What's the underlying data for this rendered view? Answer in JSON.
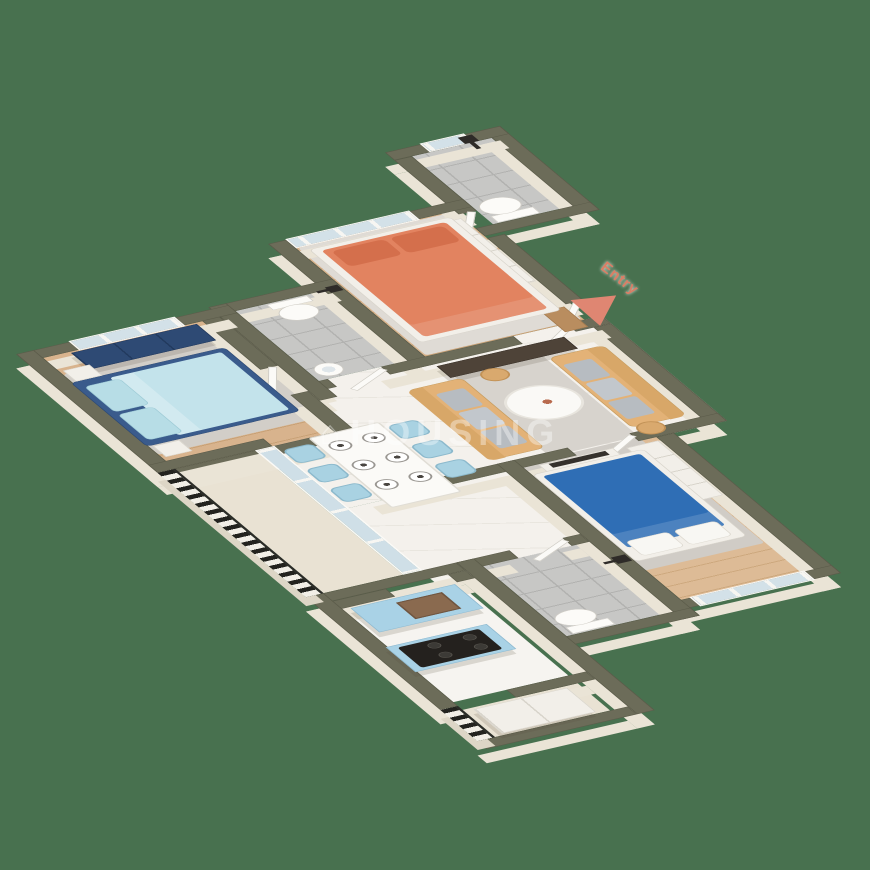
{
  "scene": {
    "background_color": "#48714f",
    "subject": "3D isometric floor plan render of a 3-bedroom apartment"
  },
  "labels": {
    "entry": {
      "text": "Entry",
      "color": "#d97f66",
      "arrow_direction": "lower-left"
    }
  },
  "watermark": {
    "icon_glyph": "⌂",
    "text": "HOUSING",
    "opacity": 0.38
  },
  "palette": {
    "wall_top": "#6c6c59",
    "wall_face": "#eae4d6",
    "wood_floor": "#d8b38d",
    "marble_floor": "#f4f1ec",
    "bath_tile": "#c7c7c5",
    "kitchen_cabinet_blue": "#a9d2e6",
    "sofa_tan": "#e3b277",
    "bed_coral": "#e28360",
    "bed_cyan_duvet": "#c3e3eb",
    "bed_navy_frame": "#3a5b8c",
    "bed_royal_blue": "#2f6eb5",
    "navy_wardrobe": "#2e4a74",
    "dining_chair_blue": "#a9d2e2",
    "rug_gray": "#d2cec8",
    "railing_dark": "#23231f"
  },
  "rooms": [
    {
      "name": "bathroom-top",
      "floor": "gray-tile",
      "features": [
        "shower",
        "toilet",
        "window"
      ]
    },
    {
      "name": "bedroom-coral",
      "floor": "wood",
      "features": [
        "double-bed-coral",
        "built-in-wardrobe",
        "window",
        "rug"
      ]
    },
    {
      "name": "bathroom-common",
      "floor": "gray-tile",
      "features": [
        "toilet",
        "washbasin",
        "shower"
      ]
    },
    {
      "name": "bedroom-navy",
      "floor": "wood",
      "features": [
        "double-bed-cyan-navy-frame",
        "navy-dresser",
        "window",
        "rug",
        "nightstands"
      ]
    },
    {
      "name": "living-room",
      "floor": "marble",
      "features": [
        "sofa-pair-tan",
        "gray-cushions",
        "round-coffee-table",
        "rug",
        "tv-console-brown",
        "side-stools",
        "doormat",
        "entry-door"
      ]
    },
    {
      "name": "dining-area",
      "floor": "marble",
      "features": [
        "dining-table-white",
        "six-blue-chairs",
        "six-place-settings"
      ]
    },
    {
      "name": "bedroom-blue",
      "floor": "wood",
      "features": [
        "double-bed-blue",
        "white-wardrobe",
        "tv-unit",
        "windows",
        "rug"
      ]
    },
    {
      "name": "bathroom-lower",
      "floor": "gray-tile",
      "features": [
        "shower",
        "toilet"
      ]
    },
    {
      "name": "kitchen",
      "floor": "white",
      "features": [
        "sink-counter-blue",
        "hob-counter-blue",
        "gas-stove"
      ]
    },
    {
      "name": "balcony",
      "features": [
        "black-white-railing",
        "sliding-glass-door"
      ]
    },
    {
      "name": "utility-balcony",
      "features": [
        "black-white-railing",
        "tall-white-unit"
      ]
    }
  ]
}
